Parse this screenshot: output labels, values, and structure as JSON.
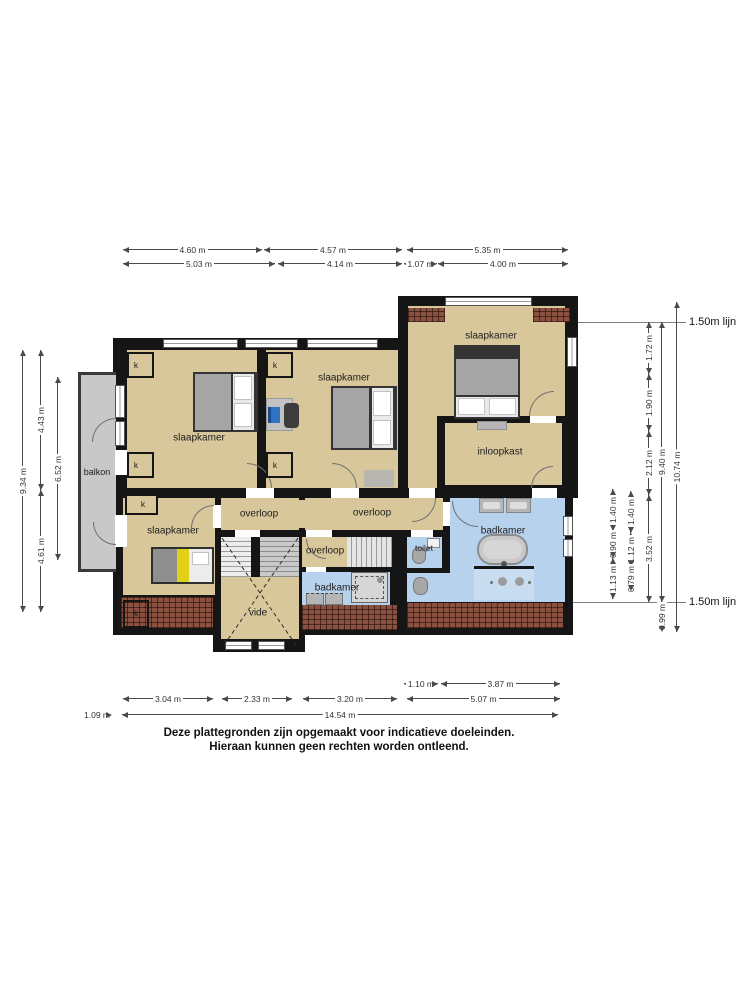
{
  "rooms": {
    "slaapkamer": "slaapkamer",
    "balkon": "balkon",
    "inloopkast": "inloopkast",
    "overloop": "overloop",
    "toilet": "toilet",
    "badkamer": "badkamer",
    "vide": "vide",
    "closet": "k"
  },
  "annotations": {
    "line_150": "1.50m lijn"
  },
  "dimensions": {
    "top_row1": [
      "4.60 m",
      "4.57 m",
      "5.35 m"
    ],
    "top_row2": [
      "5.03 m",
      "4.14 m",
      "1.07 m",
      "4.00 m"
    ],
    "left": [
      "9.34 m",
      "4.43 m",
      "4.61 m",
      "6.52 m"
    ],
    "right_col_a": [
      "1.40 m",
      "0.90 m",
      "1.13 m"
    ],
    "right_col_b": [
      "1.40 m",
      "1.12 m",
      "0.79 m"
    ],
    "right_col_c": [
      "1.72 m",
      "1.90 m",
      "2.12 m",
      "3.52 m"
    ],
    "right_col_d": [
      "9.40 m",
      "0.99 m"
    ],
    "right_col_e": [
      "10.74 m"
    ],
    "bottom_row1": [
      "1.10 m",
      "3.87 m"
    ],
    "bottom_row2": [
      "3.04 m",
      "2.33 m",
      "3.20 m",
      "5.07 m"
    ],
    "bottom_row3": [
      "1.09 m",
      "14.54 m"
    ]
  },
  "disclaimer": {
    "line1": "Deze plattegronden zijn opgemaakt voor indicatieve doeleinden.",
    "line2": "Hieraan kunnen geen rechten worden ontleend."
  },
  "colors": {
    "wall": "#151515",
    "floor": "#d8c79a",
    "wet_floor": "#b7d2ec",
    "balcony": "#c8c8c8",
    "roof_brick": "#8a5140",
    "bed_accent_yellow": "#e0d118"
  }
}
